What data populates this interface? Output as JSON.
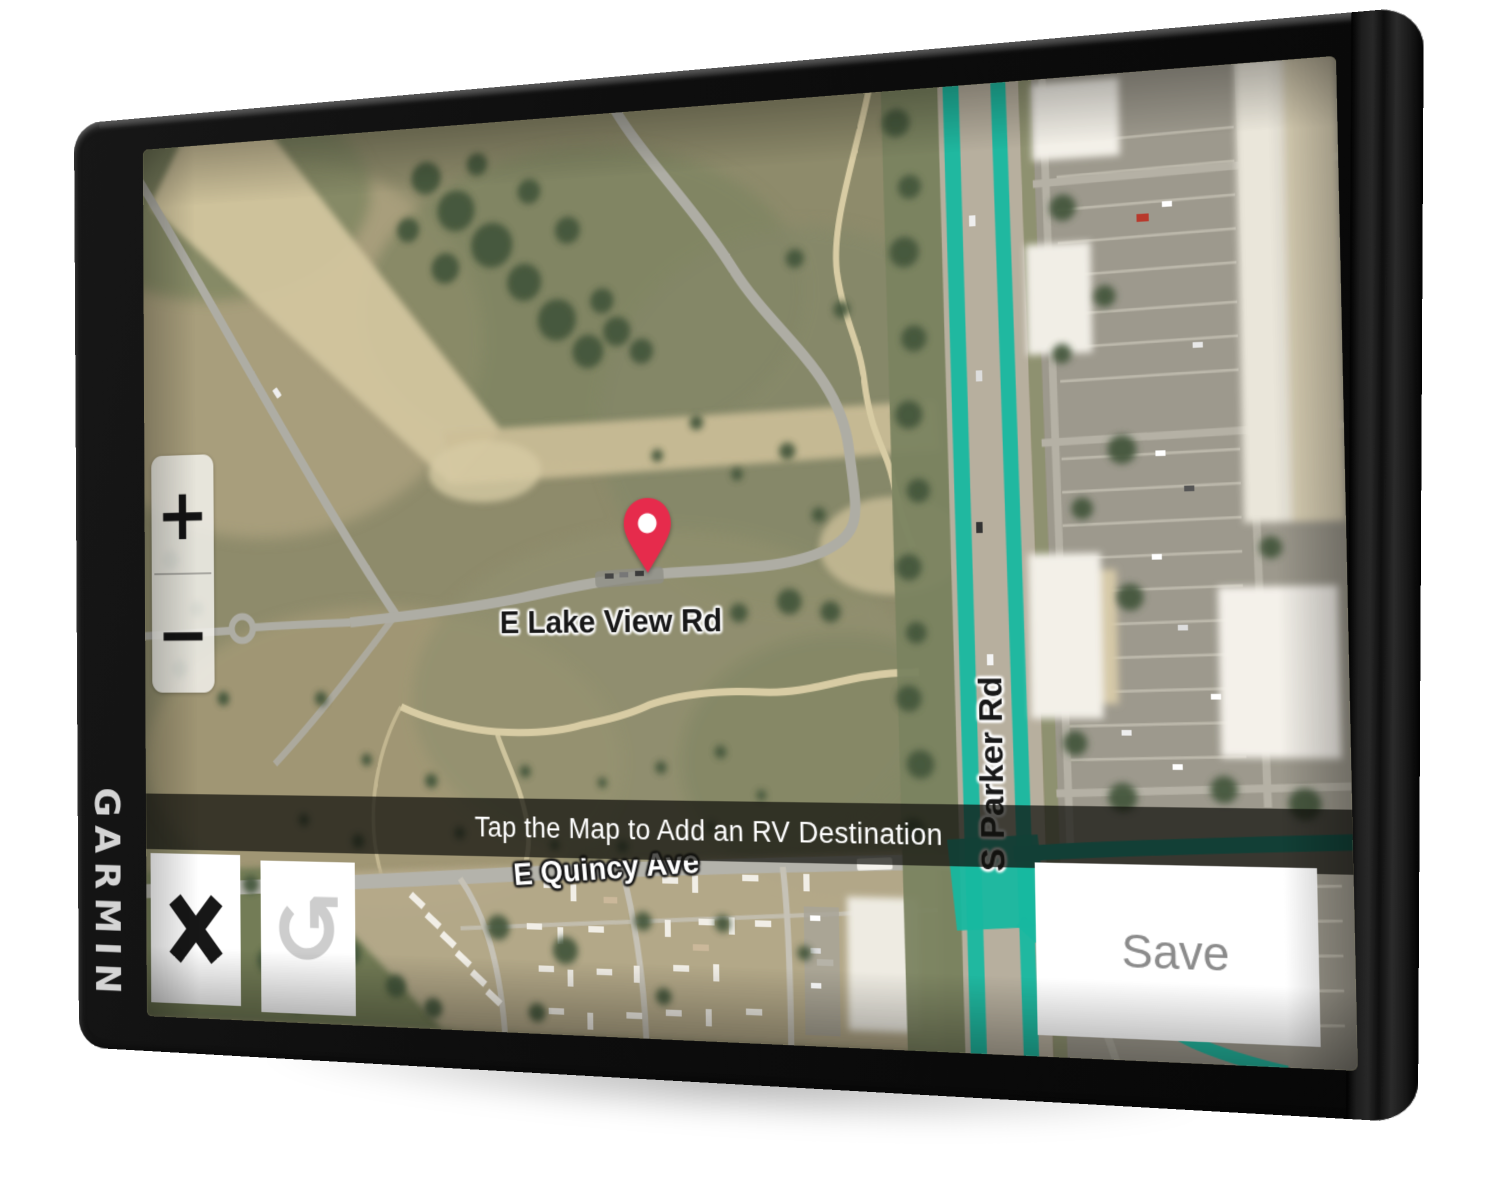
{
  "device": {
    "brand": "GARMIN"
  },
  "icons": {
    "close": "✕",
    "undo": "↺",
    "zoom_in": "+",
    "zoom_out": "−",
    "map_pin": "location-pin"
  },
  "ui": {
    "banner": "Tap the Map to Add an RV Destination",
    "save_label": "Save"
  },
  "map": {
    "labels": {
      "lake_view": "E Lake View Rd",
      "parker": "S Parker Rd",
      "quincy": "E Quincy Ave"
    },
    "colors": {
      "route": "#17b8a0",
      "pin": "#e62b4c"
    }
  }
}
